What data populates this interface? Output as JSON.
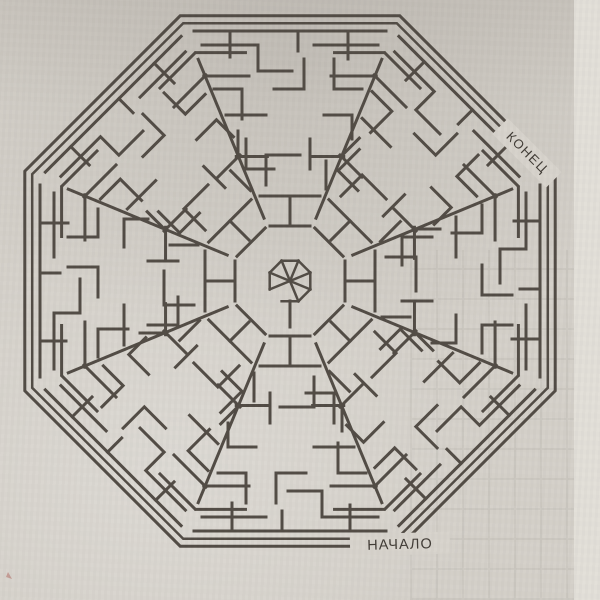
{
  "photo": {
    "paper_color": "#d5d1ca",
    "page_edge_color": "#e3e0d9",
    "ink_speck_color": "#b05a52"
  },
  "maze": {
    "type": "octagonal-labyrinth-puzzle",
    "symmetry": 8,
    "line_color": "#534d46",
    "label_color": "#423d37",
    "label_patch_color": "#d8d4cd",
    "start_label": "НАЧАЛО",
    "end_label": "КОНЕЦ"
  }
}
